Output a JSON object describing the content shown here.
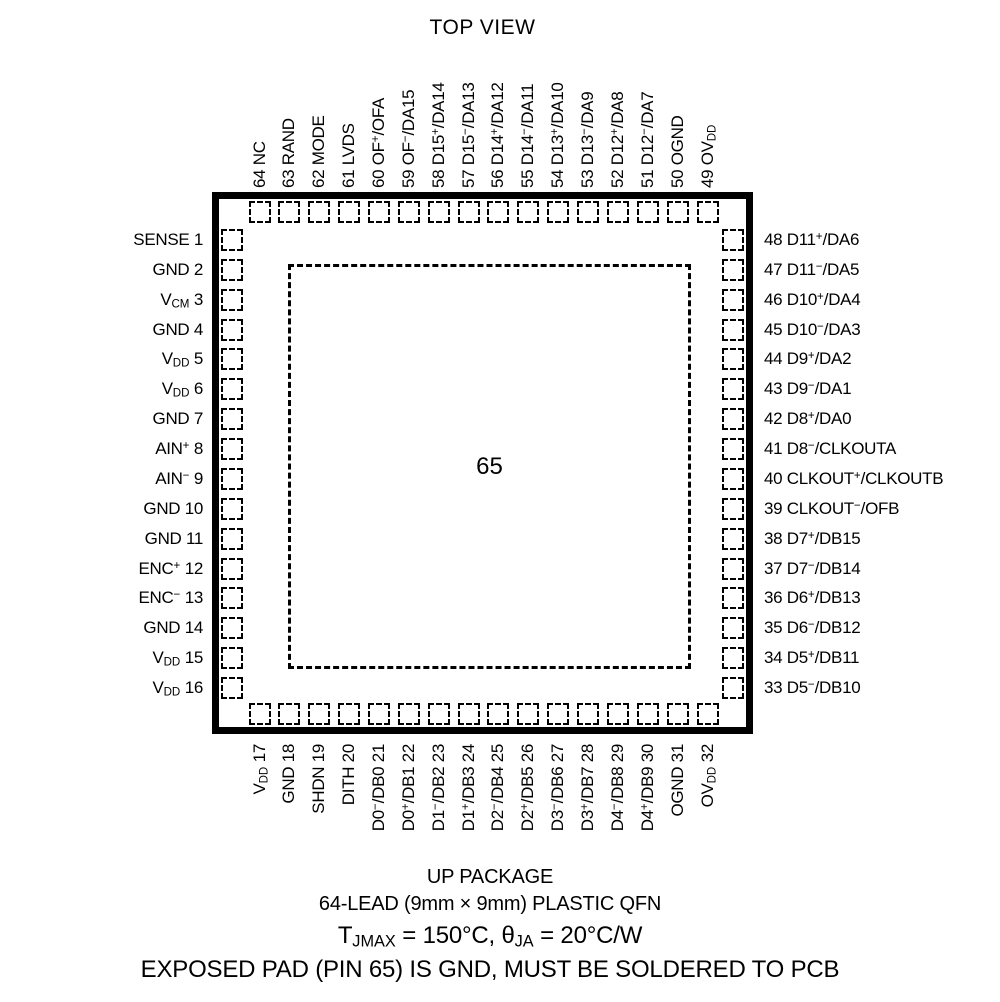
{
  "title": "TOP VIEW",
  "center_pad": {
    "pin": "65"
  },
  "pins": {
    "top": [
      {
        "pin": "64",
        "name": "NC"
      },
      {
        "pin": "63",
        "name": "RAND"
      },
      {
        "pin": "62",
        "name": "MODE"
      },
      {
        "pin": "61",
        "name": "LVDS"
      },
      {
        "pin": "60",
        "name": "OF^+^/OFA"
      },
      {
        "pin": "59",
        "name": "OF^−^/DA15"
      },
      {
        "pin": "58",
        "name": "D15^+^/DA14"
      },
      {
        "pin": "57",
        "name": "D15^−^/DA13"
      },
      {
        "pin": "56",
        "name": "D14^+^/DA12"
      },
      {
        "pin": "55",
        "name": "D14^−^/DA11"
      },
      {
        "pin": "54",
        "name": "D13^+^/DA10"
      },
      {
        "pin": "53",
        "name": "D13^−^/DA9"
      },
      {
        "pin": "52",
        "name": "D12^+^/DA8"
      },
      {
        "pin": "51",
        "name": "D12^−^/DA7"
      },
      {
        "pin": "50",
        "name": "OGND"
      },
      {
        "pin": "49",
        "name": "OV~DD~"
      }
    ],
    "left": [
      {
        "pin": "1",
        "name": "SENSE"
      },
      {
        "pin": "2",
        "name": "GND"
      },
      {
        "pin": "3",
        "name": "V~CM~"
      },
      {
        "pin": "4",
        "name": "GND"
      },
      {
        "pin": "5",
        "name": "V~DD~"
      },
      {
        "pin": "6",
        "name": "V~DD~"
      },
      {
        "pin": "7",
        "name": "GND"
      },
      {
        "pin": "8",
        "name": "AIN^+^"
      },
      {
        "pin": "9",
        "name": "AIN^−^"
      },
      {
        "pin": "10",
        "name": "GND"
      },
      {
        "pin": "11",
        "name": "GND"
      },
      {
        "pin": "12",
        "name": "ENC^+^"
      },
      {
        "pin": "13",
        "name": "ENC^−^"
      },
      {
        "pin": "14",
        "name": "GND"
      },
      {
        "pin": "15",
        "name": "V~DD~"
      },
      {
        "pin": "16",
        "name": "V~DD~"
      }
    ],
    "right": [
      {
        "pin": "48",
        "name": "D11^+^/DA6"
      },
      {
        "pin": "47",
        "name": "D11^−^/DA5"
      },
      {
        "pin": "46",
        "name": "D10^+^/DA4"
      },
      {
        "pin": "45",
        "name": "D10^−^/DA3"
      },
      {
        "pin": "44",
        "name": "D9^+^/DA2"
      },
      {
        "pin": "43",
        "name": "D9^−^/DA1"
      },
      {
        "pin": "42",
        "name": "D8^+^/DA0"
      },
      {
        "pin": "41",
        "name": "D8^−^/CLKOUTA"
      },
      {
        "pin": "40",
        "name": "CLKOUT^+^/CLKOUTB"
      },
      {
        "pin": "39",
        "name": "CLKOUT^−^/OFB"
      },
      {
        "pin": "38",
        "name": "D7^+^/DB15"
      },
      {
        "pin": "37",
        "name": "D7^−^/DB14"
      },
      {
        "pin": "36",
        "name": "D6^+^/DB13"
      },
      {
        "pin": "35",
        "name": "D6^−^/DB12"
      },
      {
        "pin": "34",
        "name": "D5^+^/DB11"
      },
      {
        "pin": "33",
        "name": "D5^−^/DB10"
      }
    ],
    "bottom": [
      {
        "pin": "17",
        "name": "V~DD~"
      },
      {
        "pin": "18",
        "name": "GND"
      },
      {
        "pin": "19",
        "name": "SHDN"
      },
      {
        "pin": "20",
        "name": "DITH"
      },
      {
        "pin": "21",
        "name": "D0^−^/DB0"
      },
      {
        "pin": "22",
        "name": "D0^+^/DB1"
      },
      {
        "pin": "23",
        "name": "D1^−^/DB2"
      },
      {
        "pin": "24",
        "name": "D1^+^/DB3"
      },
      {
        "pin": "25",
        "name": "D2^−^/DB4"
      },
      {
        "pin": "26",
        "name": "D2^+^/DB5"
      },
      {
        "pin": "27",
        "name": "D3^−^/DB6"
      },
      {
        "pin": "28",
        "name": "D3^+^/DB7"
      },
      {
        "pin": "29",
        "name": "D4^−^/DB8"
      },
      {
        "pin": "30",
        "name": "D4^+^/DB9"
      },
      {
        "pin": "31",
        "name": "OGND"
      },
      {
        "pin": "32",
        "name": "OV~DD~"
      }
    ]
  },
  "footer": {
    "line1": "UP PACKAGE",
    "line2": "64-LEAD (9mm × 9mm) PLASTIC QFN",
    "line3": "T~JMAX~ = 150°C, θ~JA~ = 20°C/W",
    "line4": "EXPOSED PAD (PIN 65) IS GND, MUST BE SOLDERED TO PCB"
  },
  "colors": {
    "line": "#000000",
    "background": "#ffffff"
  }
}
